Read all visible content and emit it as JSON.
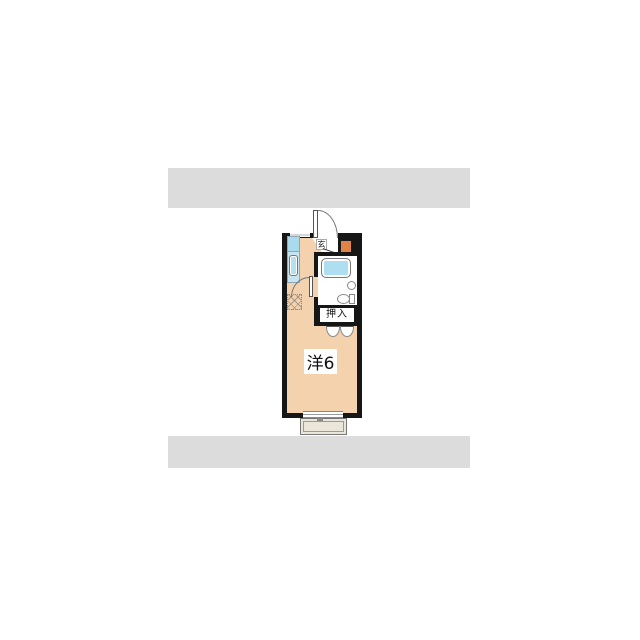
{
  "photo_panel": {
    "description": "apartment floor plan photo centered on white page with gray letterbox bars"
  },
  "floorplan": {
    "labels": {
      "entrance": "玄",
      "closet": "押入",
      "main_room": "洋6"
    },
    "fixtures": [
      "entrance-door",
      "shoe-cabinet",
      "kitchen-counter",
      "gas-stove",
      "kitchen-sink",
      "bathtub",
      "wash-basin",
      "toilet",
      "bathroom-door",
      "washing-machine-space",
      "closet-double-doors",
      "window",
      "balcony"
    ],
    "colors": {
      "wall": "#161616",
      "floor": "#f3d2ad",
      "fixture_blue": "#aedff1",
      "counter_blue": "#c6e5f1",
      "stove_blue": "#a9daed",
      "sink_blue": "#b4e0f0",
      "cabinet_orange": "#e08347",
      "balcony": "#ebe6da",
      "letterbox": "#dcdcdc"
    }
  }
}
